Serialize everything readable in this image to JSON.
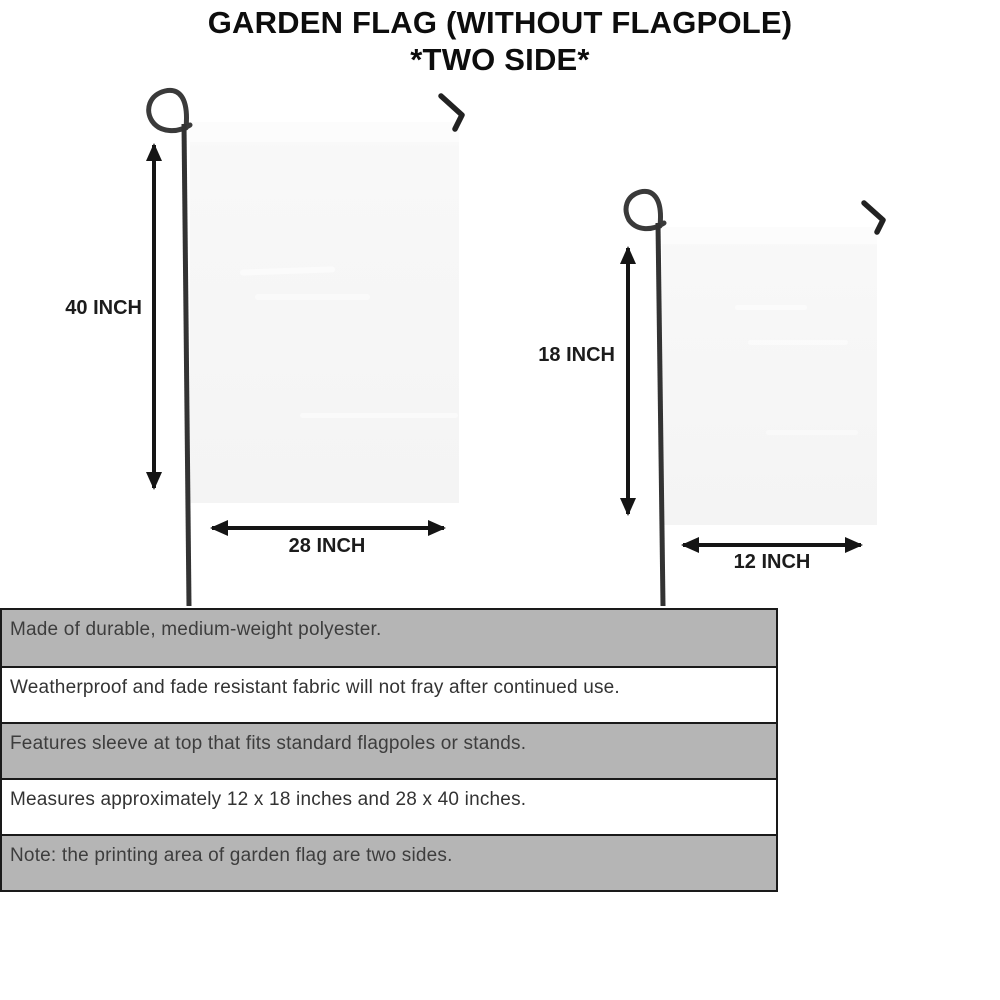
{
  "title": {
    "line1": "GARDEN FLAG (WITHOUT FLAGPOLE)",
    "line2": "*TWO SIDE*"
  },
  "flags": {
    "large": {
      "height_label": "40 INCH",
      "width_label": "28 INCH"
    },
    "small": {
      "height_label": "18 INCH",
      "width_label": "12 INCH"
    }
  },
  "features": [
    "Made of durable, medium-weight polyester.",
    "Weatherproof and fade resistant fabric will not fray after continued use.",
    "Features sleeve at top that fits standard flagpoles or stands.",
    "Measures approximately 12 x 18 inches and 28 x 40 inches.",
    "Note: the printing area of garden flag are two sides."
  ],
  "colors": {
    "row_gray": "#b5b5b5",
    "table_border": "#1a1a1a",
    "flag_fill": "#f6f6f6",
    "pole": "#333333",
    "ink": "#141414"
  }
}
